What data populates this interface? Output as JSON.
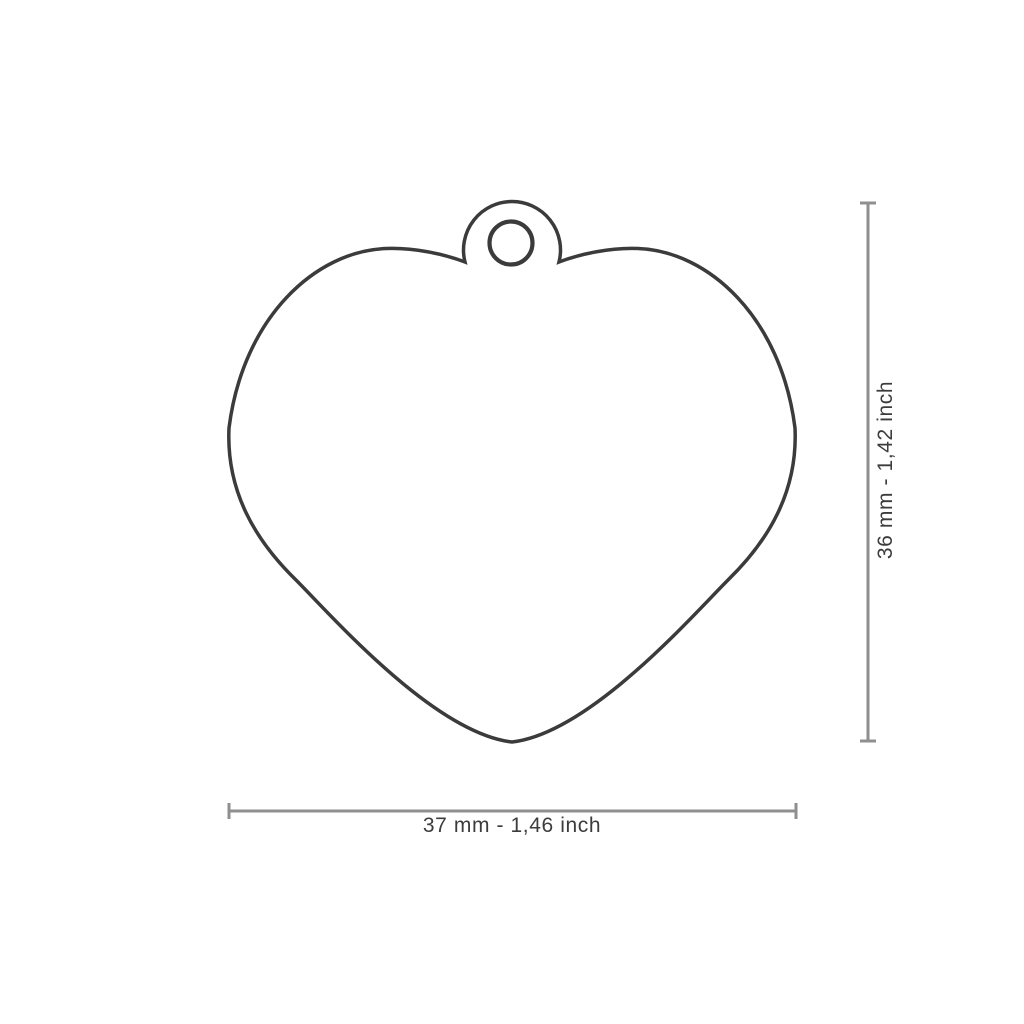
{
  "figure": {
    "shape_name": "heart-tag-outline",
    "hole_name": "hanging-hole"
  },
  "dimensions": {
    "width": {
      "label": "37 mm - 1,46 inch",
      "mm": 37,
      "inch": "1,46"
    },
    "height": {
      "label": "36 mm - 1,42 inch",
      "mm": 36,
      "inch": "1,42"
    }
  },
  "colors": {
    "background": "#ffffff",
    "outline": "#3b3b3b",
    "dimension_line": "#8f8f8f",
    "label_text": "#3c3c3c"
  }
}
